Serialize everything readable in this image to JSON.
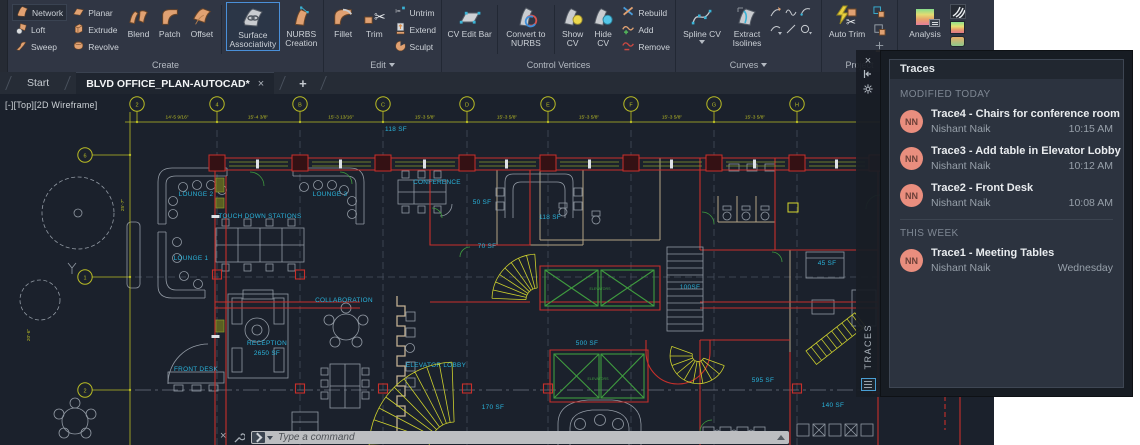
{
  "ribbon": {
    "create": {
      "label": "Create",
      "small": [
        "Network",
        "Loft",
        "Sweep",
        "Planar",
        "Extrude",
        "Revolve"
      ],
      "large": [
        "Blend",
        "Patch",
        "Offset",
        "Surface Associativity",
        "NURBS Creation"
      ]
    },
    "edit": {
      "label": "Edit",
      "large": [
        "Fillet",
        "Trim"
      ],
      "small": [
        "Untrim",
        "Extend",
        "Sculpt"
      ]
    },
    "control_vertices": {
      "label": "Control Vertices",
      "large": [
        "CV Edit Bar",
        "Convert to NURBS",
        "Show CV",
        "Hide CV"
      ],
      "small": [
        "Rebuild",
        "Add",
        "Remove"
      ]
    },
    "curves": {
      "label": "Curves",
      "large": [
        "Spline CV",
        "Extract Isolines"
      ]
    },
    "project": {
      "label": "Project",
      "large": [
        "Auto Trim"
      ]
    },
    "analysis": {
      "label": "Analysis",
      "large": [
        "Analysis"
      ]
    }
  },
  "tabs": {
    "start": "Start",
    "drawing": "BLVD OFFICE_PLAN-AUTOCAD*",
    "close": "×",
    "new_tab": "+"
  },
  "viewport": {
    "label": "[-][Top][2D Wireframe]"
  },
  "command": {
    "placeholder": "Type a command"
  },
  "traces": {
    "title": "Traces",
    "vertical_label": "TRACES",
    "sections": [
      {
        "header": "MODIFIED TODAY",
        "items": [
          {
            "avatar": "NN",
            "title": "Trace4 - Chairs for conference room",
            "author": "Nishant Naik",
            "time": "10:15 AM"
          },
          {
            "avatar": "NN",
            "title": "Trace3 - Add table in Elevator Lobby",
            "author": "Nishant Naik",
            "time": "10:12 AM"
          },
          {
            "avatar": "NN",
            "title": "Trace2 - Front Desk",
            "author": "Nishant Naik",
            "time": "10:08 AM"
          }
        ]
      },
      {
        "header": "THIS WEEK",
        "items": [
          {
            "avatar": "NN",
            "title": "Trace1 - Meeting Tables",
            "author": "Nishant Naik",
            "time": "Wednesday"
          }
        ]
      }
    ]
  },
  "drawing": {
    "grid_top": {
      "xs": [
        137,
        217,
        300,
        383,
        467,
        548,
        631,
        714,
        797
      ],
      "labels": [
        "2",
        "4",
        "B",
        "C",
        "D",
        "E",
        "F",
        "G",
        "H"
      ]
    },
    "grid_left": [
      {
        "y": 155,
        "label": "6"
      },
      {
        "y": 277,
        "label": "1"
      },
      {
        "y": 390,
        "label": "2"
      }
    ],
    "dims_top": {
      "xs": [
        177,
        258,
        341,
        425,
        507,
        589,
        672,
        755
      ],
      "texts": [
        "14'-5 9/16\"",
        "15'-4 3/8\"",
        "15'-3 13/16\"",
        "15'-3 5/8\"",
        "15'-3 5/8\"",
        "15'-3 5/8\"",
        "15'-3 5/8\"",
        "15'-3 5/8\""
      ]
    },
    "dims_left": [
      {
        "x": 124,
        "y": 205,
        "text": "25'-7\""
      },
      {
        "x": 30,
        "y": 335,
        "text": "20'-6\""
      }
    ],
    "room_labels": [
      {
        "t": "118 SF",
        "x": 396,
        "y": 131
      },
      {
        "t": "LOUNGE 2",
        "x": 196,
        "y": 196
      },
      {
        "t": "LOUNGE 3",
        "x": 330,
        "y": 196
      },
      {
        "t": "TOUCH DOWN STATIONS",
        "x": 260,
        "y": 218
      },
      {
        "t": "LOUNGE 1",
        "x": 191,
        "y": 260
      },
      {
        "t": "CONFERENCE",
        "x": 437,
        "y": 184
      },
      {
        "t": "50 SF",
        "x": 482,
        "y": 204
      },
      {
        "t": "118 SF",
        "x": 550,
        "y": 219
      },
      {
        "t": "70 SF",
        "x": 487,
        "y": 248
      },
      {
        "t": "COLLABORATION",
        "x": 344,
        "y": 302
      },
      {
        "t": "RECEPTION",
        "x": 267,
        "y": 345
      },
      {
        "t": "2650 SF",
        "x": 267,
        "y": 355
      },
      {
        "t": "FRONT DESK",
        "x": 196,
        "y": 371
      },
      {
        "t": "ELEVATOR LOBBY",
        "x": 436,
        "y": 367
      },
      {
        "t": "100SF",
        "x": 690,
        "y": 289
      },
      {
        "t": "500 SF",
        "x": 587,
        "y": 345
      },
      {
        "t": "170 SF",
        "x": 493,
        "y": 409
      },
      {
        "t": "595 SF",
        "x": 763,
        "y": 382
      },
      {
        "t": "140 SF",
        "x": 833,
        "y": 407
      },
      {
        "t": "45 SF",
        "x": 827,
        "y": 265
      }
    ],
    "elevator_labels": [
      {
        "t": "ELEVATORS",
        "x": 600,
        "y": 290
      },
      {
        "t": "ELEVATORS",
        "x": 598,
        "y": 380
      }
    ],
    "colors": {
      "wall_red": "#c8302b",
      "dim_yellow": "#b9bc25",
      "label_cyan": "#2ab4dc",
      "green": "#3f9b3f",
      "accent_blue": "#4a90d9",
      "avatar_salmon": "#e98e7e"
    }
  }
}
